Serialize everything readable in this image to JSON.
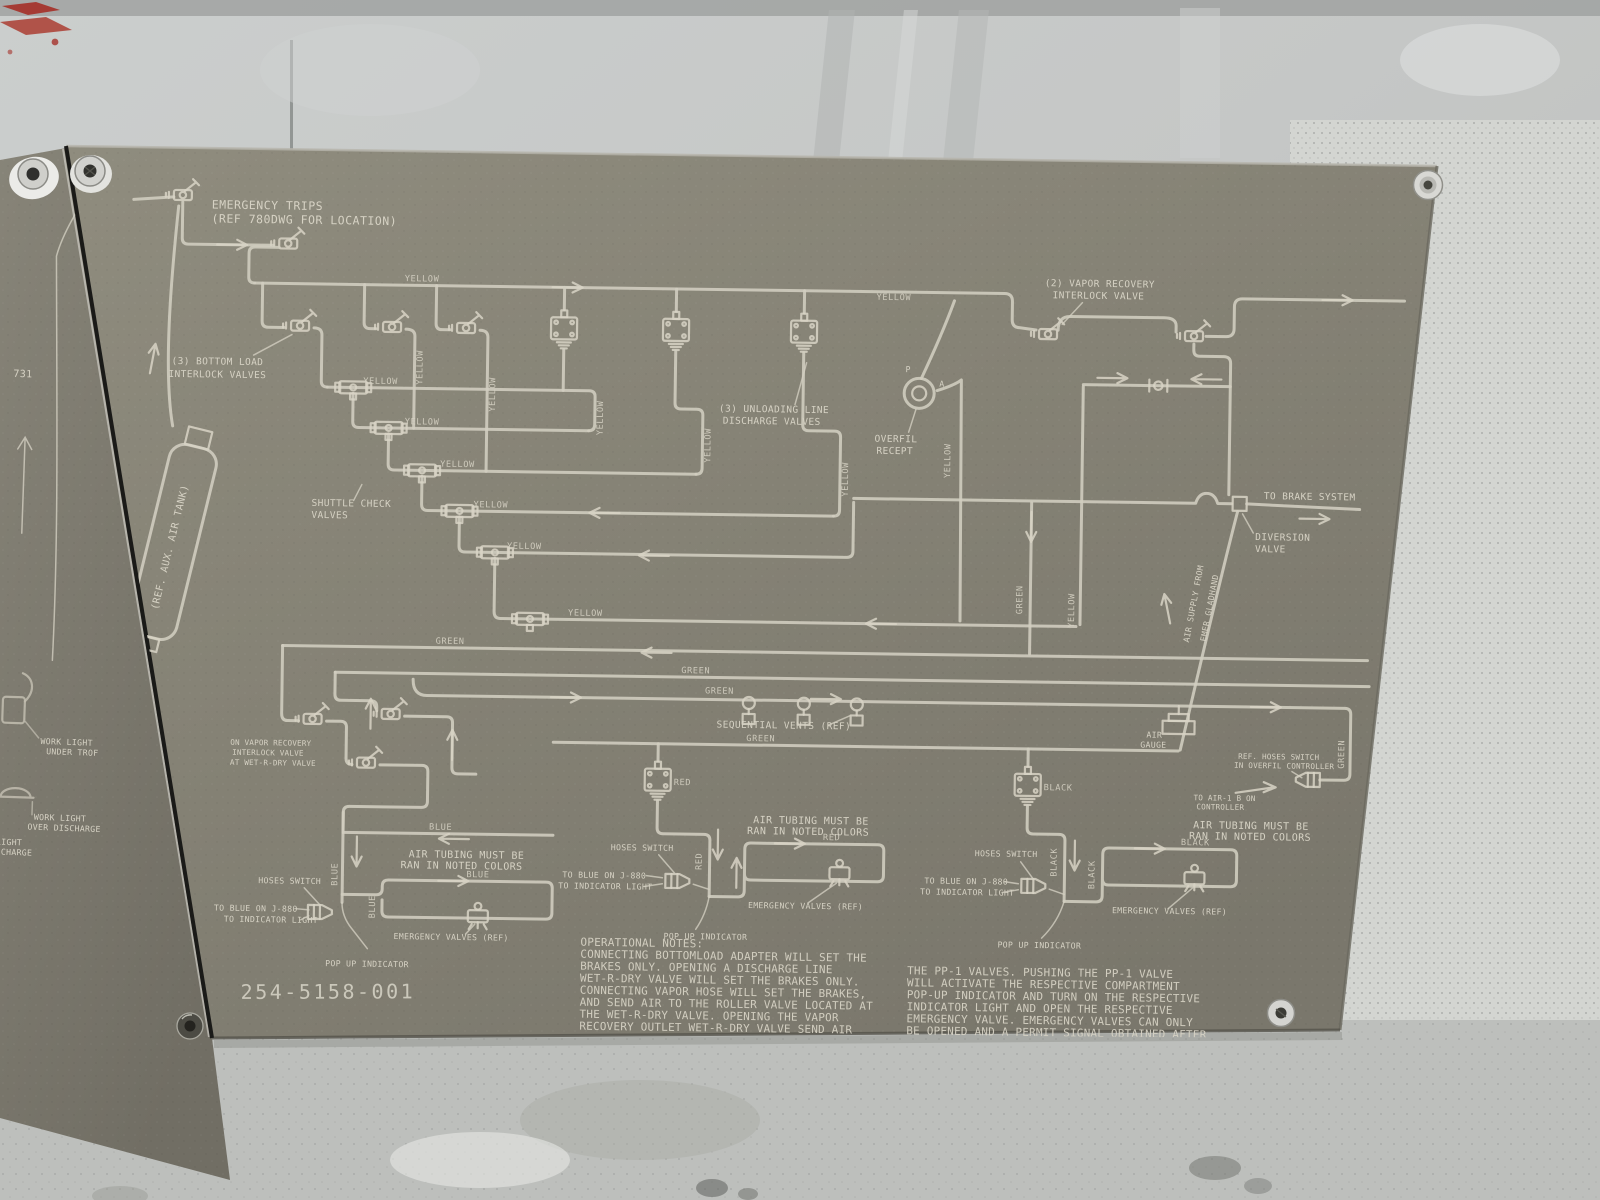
{
  "left_panel": {
    "ref_number": "731",
    "work_light_under": [
      "WORK LIGHT",
      "UNDER TROF"
    ],
    "work_light_over": [
      "WORK LIGHT",
      "OVER DISCHARGE"
    ],
    "cut_label": [
      "LIGHT",
      "SCHARGE"
    ]
  },
  "diagram": {
    "part_number": "254-5158-001",
    "labels": {
      "emergency_trips": [
        "EMERGENCY TRIPS",
        "(REF 780DWG FOR LOCATION)"
      ],
      "bottom_load": [
        "(3) BOTTOM LOAD",
        "INTERLOCK VALVES"
      ],
      "shuttle_check": [
        "SHUTTLE CHECK",
        "VALVES"
      ],
      "unloading": [
        "(3) UNLOADING LINE",
        "DISCHARGE VALVES"
      ],
      "overfil": [
        "OVERFIL",
        "RECEPT"
      ],
      "port_p": "P",
      "port_a": "A",
      "vapor_recovery": [
        "(2) VAPOR RECOVERY",
        "INTERLOCK VALVE"
      ],
      "to_brake_system": "TO BRAKE SYSTEM",
      "diversion": [
        "DIVERSION",
        "VALVE"
      ],
      "air_supply": [
        "AIR SUPPLY FROM",
        "EMER GLADHAND"
      ],
      "aux_tank": "(REF. AUX. AIR TANK)",
      "on_vapor": [
        "ON VAPOR RECOVERY",
        "INTERLOCK VALVE",
        "AT WET-R-DRY VALVE"
      ],
      "sequential_vents": "SEQUENTIAL VENTS (REF)",
      "air_gauge": [
        "AIR",
        "GAUGE"
      ],
      "ref_hoses": [
        "REF. HOSES SWITCH",
        "IN OVERFIL CONTROLLER"
      ],
      "to_air1b": [
        "TO AIR-1 B ON",
        "CONTROLLER"
      ],
      "air_tubing": [
        "AIR TUBING MUST BE",
        "RAN IN NOTED COLORS"
      ],
      "hoses_switch": "HOSES SWITCH",
      "to_blue_j880": "TO BLUE ON J-880",
      "to_indicator": "TO INDICATOR LIGHT",
      "pop_up": "POP UP INDICATOR",
      "emergency_valves": "EMERGENCY VALVES (REF)"
    },
    "colors": {
      "yellow": "YELLOW",
      "green": "GREEN",
      "blue": "BLUE",
      "red": "RED",
      "black": "BLACK"
    },
    "notes": {
      "title": "OPERATIONAL NOTES:",
      "left": [
        "CONNECTING BOTTOMLOAD ADAPTER WILL SET THE",
        "BRAKES ONLY. OPENING A DISCHARGE LINE",
        "WET-R-DRY VALVE WILL SET THE BRAKES ONLY.",
        "CONNECTING VAPOR HOSE WILL SET THE BRAKES,",
        "AND SEND AIR TO THE ROLLER VALVE LOCATED AT",
        "THE WET-R-DRY VALVE. OPENING THE VAPOR",
        "RECOVERY OUTLET WET-R-DRY VALVE SEND AIR",
        "THRU THE VAPOR RECOVERY VENTS, GIVE A PERMIT",
        "SIGNAL ON THE OVERFIL SYSTEM AND SEND AIR TO"
      ],
      "right": [
        "THE PP-1 VALVES. PUSHING THE PP-1 VALVE",
        "WILL ACTIVATE THE RESPECTIVE COMPARTMENT",
        "POP-UP INDICATOR AND TURN ON THE RESPECTIVE",
        "INDICATOR LIGHT AND OPEN THE RESPECTIVE",
        "EMERGENCY VALVE. EMERGENCY VALVES CAN ONLY",
        "BE OPENED AND A PERMIT SIGNAL OBTAINED AFTER",
        "THE VENTS ARE OPENED AND ONLY AFTER THE",
        "WET-R-DRY VALVE IS OPENED AND ROLLER CAM",
        "VALVE IS ACTIVATED."
      ]
    }
  }
}
